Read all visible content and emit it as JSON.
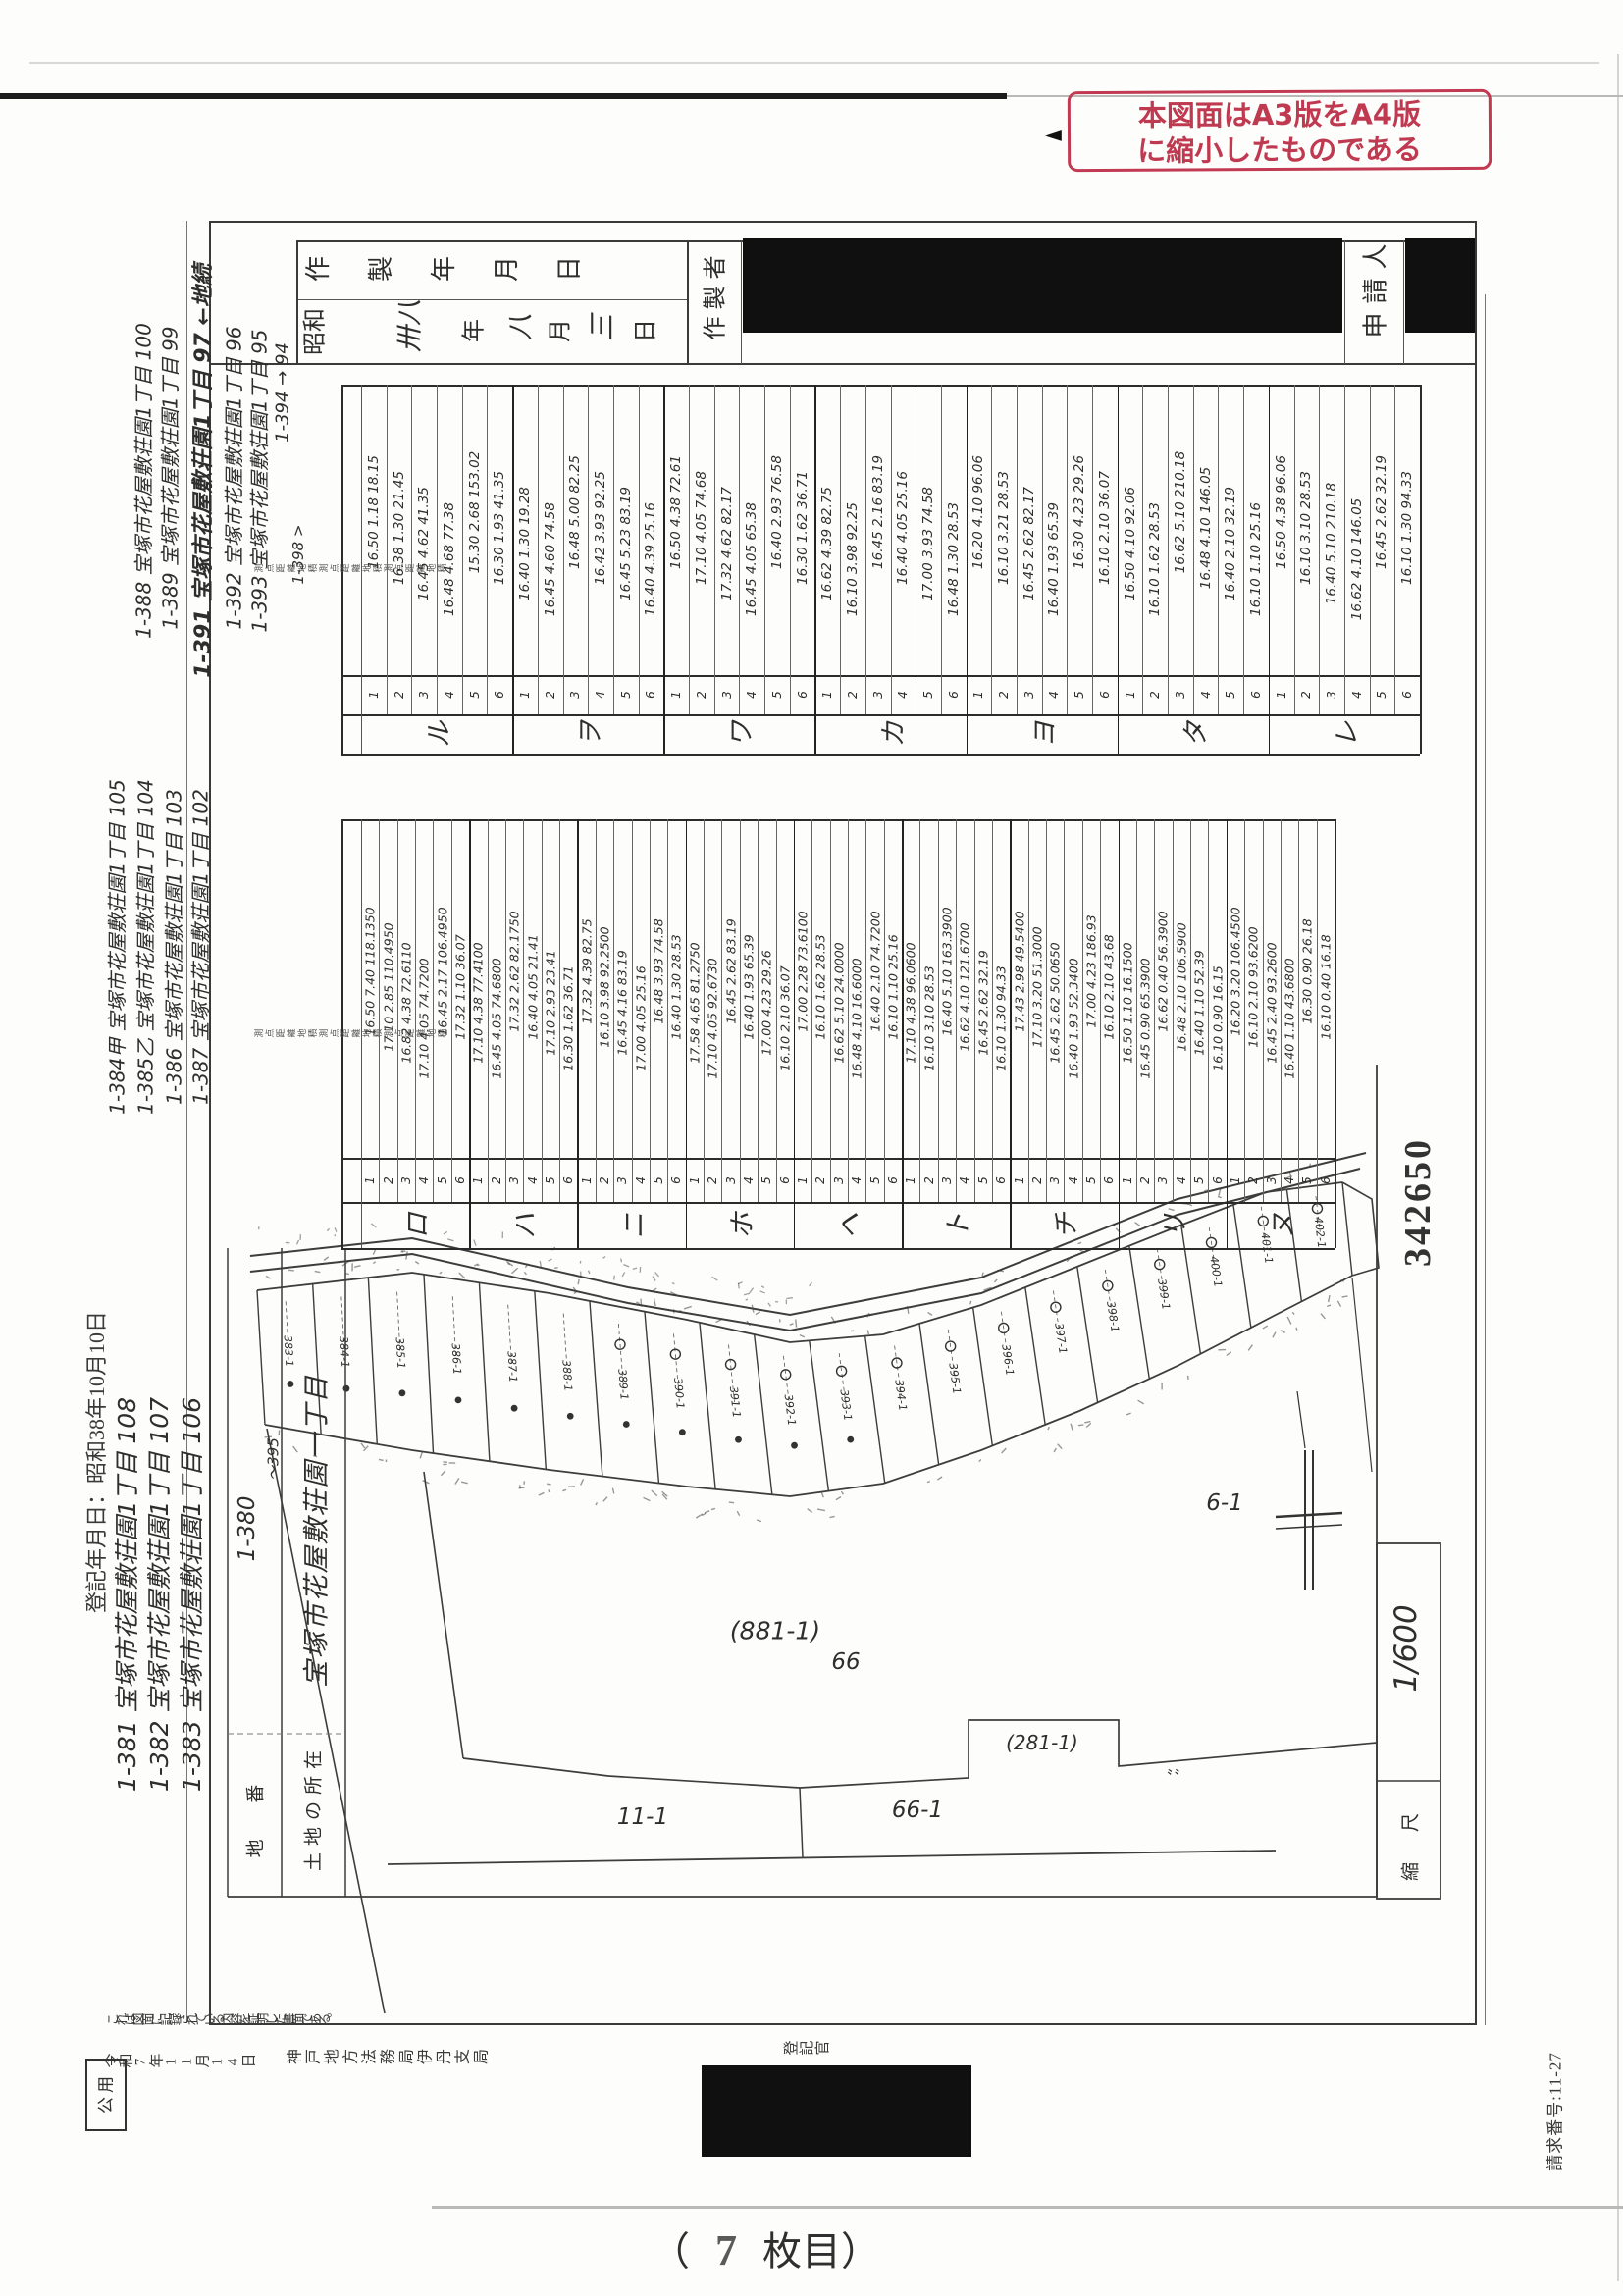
{
  "stamp": {
    "line1": "本図面はA3版をA4版",
    "line2": "に縮小したものである",
    "color": "#c23a52"
  },
  "title_block": {
    "label_chars": "作製年月日",
    "era": "昭和",
    "year_written": "卅八",
    "year": "年",
    "month_written": "八",
    "month": "月",
    "day_written": "三",
    "day": "日",
    "creator_label": "作製者",
    "applicant_label": "申請人"
  },
  "tables": {
    "table1": {
      "side_label": "測点距離地積測点距離地積測点距離地積",
      "symbols": [
        "ル",
        "ヲ",
        "ワ",
        "カ",
        "ヨ",
        "タ",
        "レ"
      ],
      "points": [
        "1",
        "2",
        "3",
        "4",
        "5",
        "6"
      ],
      "columns": [
        [
          "16.50 1.18 18.15",
          "16.38 1.30 21.45",
          "16.45 4.62 41.35",
          "16.48 4.68 77.38",
          "15.30 2.68 153.02",
          "16.30 1.93 41.35"
        ],
        [
          "16.40 1.30 19.28",
          "16.45 4.60 74.58",
          "16.48 5.00 82.25",
          "16.42 3.93 92.25",
          "16.45 5.23 83.19",
          "16.40 4.39 25.16"
        ],
        [
          "16.50 4.38 72.61",
          "17.10 4.05 74.68",
          "17.32 4.62 82.17",
          "16.45 4.05 65.38",
          "16.40 2.93 76.58",
          "16.30 1.62 36.71"
        ],
        [
          "16.62 4.39 82.75",
          "16.10 3.98 92.25",
          "16.45 2.16 83.19",
          "16.40 4.05 25.16",
          "17.00 3.93 74.58",
          "16.48 1.30 28.53"
        ],
        [
          "16.20 4.10 96.06",
          "16.10 3.21 28.53",
          "16.45 2.62 82.17",
          "16.40 1.93 65.39",
          "16.30 4.23 29.26",
          "16.10 2.10 36.07"
        ],
        [
          "16.50 4.10 92.06",
          "16.10 1.62 28.53",
          "16.62 5.10 210.18",
          "16.48 4.10 146.05",
          "16.40 2.10 32.19",
          "16.10 1.10 25.16"
        ],
        [
          "16.50 4.38 96.06",
          "16.10 3.10 28.53",
          "16.40 5.10 210.18",
          "16.62 4.10 146.05",
          "16.45 2.62 32.19",
          "16.10 1.30 94.33"
        ]
      ]
    },
    "table2": {
      "side_label": "測点距離地積測点距離地積測点距離地積",
      "symbols": [
        "ロ",
        "ハ",
        "ニ",
        "ホ",
        "ヘ",
        "ト",
        "チ",
        "リ",
        "ヌ"
      ],
      "points": [
        "1",
        "2",
        "3",
        "4",
        "5",
        "6"
      ],
      "columns": [
        [
          "16.50 7.40 118.1350",
          "17.10 2.85 110.4950",
          "16.82 4.38 72.6110",
          "17.10 4.05 74.7200",
          "16.45 2.17 106.4950",
          "17.32 1.10 36.07"
        ],
        [
          "17.10 4.38 77.4100",
          "16.45 4.05 74.6800",
          "17.32 2.62 82.1750",
          "16.40 4.05 21.41",
          "17.10 2.93 23.41",
          "16.30 1.62 36.71"
        ],
        [
          "17.32 4.39 82.75",
          "16.10 3.98 92.2500",
          "16.45 4.16 83.19",
          "17.00 4.05 25.16",
          "16.48 3.93 74.58",
          "16.40 1.30 28.53"
        ],
        [
          "17.58 4.65 81.2750",
          "17.10 4.05 92.6730",
          "16.45 2.62 83.19",
          "16.40 1.93 65.39",
          "17.00 4.23 29.26",
          "16.10 2.10 36.07"
        ],
        [
          "17.00 2.28 73.6100",
          "16.10 1.62 28.53",
          "16.62 5.10 24.0000",
          "16.48 4.10 16.6000",
          "16.40 2.10 74.7200",
          "16.10 1.10 25.16"
        ],
        [
          "17.10 4.38 96.0600",
          "16.10 3.10 28.53",
          "16.40 5.10 163.3900",
          "16.62 4.10 121.6700",
          "16.45 2.62 32.19",
          "16.10 1.30 94.33"
        ],
        [
          "17.43 2.98 49.5400",
          "17.10 3.20 51.3000",
          "16.45 2.62 50.0650",
          "16.40 1.93 52.3400",
          "17.00 4.23 186.93",
          "16.10 2.10 43.68"
        ],
        [
          "16.50 1.10 16.1500",
          "16.45 0.90 65.3900",
          "16.62 0.40 56.3900",
          "16.48 2.10 106.5900",
          "16.40 1.10 52.39",
          "16.10 0.90 16.15"
        ],
        [
          "16.20 3.20 106.4500",
          "16.10 2.10 93.6200",
          "16.45 2.40 93.2600",
          "16.40 1.10 43.6800",
          "16.30 0.90 26.18",
          "16.10 0.40 16.18"
        ]
      ]
    }
  },
  "margin_notes": {
    "groupA": [
      "1-388 宝塚市花屋敷荘園1丁目 100",
      "1-389 宝塚市花屋敷荘園1丁目 99",
      "1-391 宝塚市花屋敷荘園1丁目 97 ←地続",
      "1-392 宝塚市花屋敷荘園1丁目 96",
      "1-393 宝塚市花屋敷荘園1丁目 95",
      "1-394 → 94",
      "1-398 >"
    ],
    "groupB": [
      "1-384甲 宝塚市花屋敷荘園1丁目 105",
      "1-385乙 宝塚市花屋敷荘園1丁目 104",
      "1-386 宝塚市花屋敷荘園1丁目 103",
      "1-387 宝塚市花屋敷荘園1丁目 102"
    ],
    "groupC": [
      "1-381 宝塚市花屋敷荘園1丁目 108",
      "1-382 宝塚市花屋敷荘園1丁目 107",
      "1-383 宝塚市花屋敷荘園1丁目 106"
    ]
  },
  "map": {
    "lots": [
      "383-1",
      "384-1",
      "385-1",
      "386-1",
      "387-1",
      "388-1",
      "389-1",
      "390-1",
      "391-1",
      "392-1",
      "393-1",
      "394-1",
      "395-1",
      "396-1",
      "397-1",
      "398-1",
      "399-1",
      "400-1",
      "401-1",
      "402-1"
    ],
    "parcels": {
      "main": "(881-1)",
      "main2": "66",
      "south": "66-1",
      "southwest": "11-1",
      "notch": "(281-1)",
      "east": "6-1",
      "notch_marks": "〟〟"
    },
    "landlot_col": {
      "number": "1-380",
      "range": "〜395",
      "location": "宝塚市花屋敷荘園一丁目"
    },
    "labels": {
      "chiban": "地 番",
      "shozai": "土地の所在",
      "scale_label": "縮 尺",
      "scale_value": "1/600"
    },
    "serial": "342650"
  },
  "certificate": {
    "statement": "これは図面に記録されている内容を証明した書面である。",
    "date": "令和7年11月14日",
    "office": "神戸地方法務局伊丹支局",
    "officer": "登記官",
    "public_use": "公用",
    "registered_date": "登記年月日：昭和38年10月10日",
    "request_no": "請求番号:11-27"
  },
  "footer": {
    "open": "（",
    "page_no": "7",
    "close": "枚目）"
  }
}
